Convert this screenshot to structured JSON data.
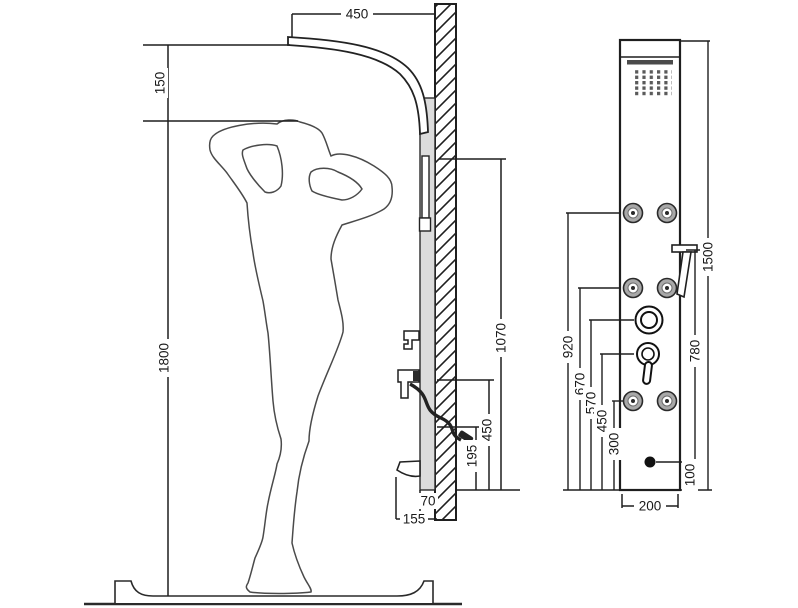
{
  "diagram": {
    "type": "technical-installation-drawing",
    "subject": "shower panel mounting dimensions with human figure",
    "units_implied": "mm",
    "colors": {
      "line": "#1f1f1f",
      "panel_fill": "#dcdcdc",
      "fixture_dark": "#4a4a4a"
    },
    "side_view": {
      "description": "side elevation: woman silhouette, shower arm, wall section, panel profile",
      "dims": {
        "arm_projection": "450",
        "head_clearance": "150",
        "figure_height": "1800",
        "rail_drop": "1070",
        "hose_height": "450",
        "handshower_rest": "195",
        "panel_depth": "70",
        "spout_projection": "155"
      }
    },
    "front_view": {
      "description": "front elevation of shower panel column",
      "dims": {
        "panel_height": "1500",
        "jets_top_height": "920",
        "handshower_height": "780",
        "jets_middle_height": "670",
        "diverter_height": "570",
        "mixer_height": "450",
        "jets_bottom_height": "300",
        "spout_outlet_height": "100",
        "panel_width": "200"
      }
    }
  }
}
